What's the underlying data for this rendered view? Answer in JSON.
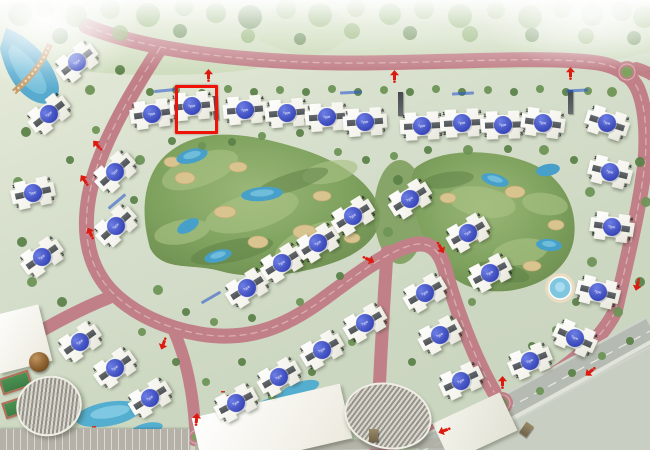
{
  "map": {
    "unit_type_label": "Type",
    "corner_unit_numbers": [
      "1",
      "4",
      "2",
      "3"
    ],
    "selected_building": {
      "index": 7,
      "x": 175,
      "y": 85,
      "w": 37,
      "h": 43
    },
    "buildings_xyr": [
      [
        77,
        62,
        -38
      ],
      [
        49,
        114,
        -38
      ],
      [
        33,
        193,
        -12
      ],
      [
        42,
        257,
        -35
      ],
      [
        115,
        172,
        -42
      ],
      [
        116,
        226,
        -42
      ],
      [
        152,
        114,
        -8
      ],
      [
        192,
        106,
        -5
      ],
      [
        245,
        110,
        -5
      ],
      [
        287,
        113,
        -5
      ],
      [
        327,
        117,
        -4
      ],
      [
        365,
        122,
        -4
      ],
      [
        422,
        126,
        -3
      ],
      [
        462,
        123,
        -3
      ],
      [
        503,
        125,
        -2
      ],
      [
        543,
        123,
        8
      ],
      [
        607,
        123,
        18
      ],
      [
        610,
        172,
        14
      ],
      [
        612,
        227,
        8
      ],
      [
        598,
        292,
        14
      ],
      [
        575,
        338,
        24
      ],
      [
        247,
        288,
        -32
      ],
      [
        282,
        263,
        -32
      ],
      [
        318,
        243,
        -32
      ],
      [
        353,
        216,
        -32
      ],
      [
        410,
        199,
        -32
      ],
      [
        468,
        233,
        -30
      ],
      [
        490,
        273,
        -28
      ],
      [
        425,
        293,
        -30
      ],
      [
        80,
        342,
        -35
      ],
      [
        115,
        368,
        -35
      ],
      [
        150,
        398,
        -32
      ],
      [
        365,
        323,
        -30
      ],
      [
        322,
        350,
        -30
      ],
      [
        279,
        377,
        -30
      ],
      [
        236,
        403,
        -28
      ],
      [
        440,
        335,
        -28
      ],
      [
        461,
        381,
        -25
      ],
      [
        530,
        361,
        -22
      ]
    ],
    "direction_arrows": [
      [
        208,
        75,
        0
      ],
      [
        394,
        76,
        0
      ],
      [
        570,
        73,
        0
      ],
      [
        97,
        145,
        -42
      ],
      [
        84,
        180,
        -35
      ],
      [
        90,
        233,
        -25
      ],
      [
        368,
        259,
        115
      ],
      [
        440,
        247,
        150
      ],
      [
        637,
        284,
        195
      ],
      [
        590,
        371,
        230
      ],
      [
        196,
        419,
        5
      ],
      [
        502,
        382,
        0
      ],
      [
        444,
        430,
        250
      ],
      [
        163,
        343,
        200
      ]
    ],
    "colors": {
      "road_pink": "#c18088",
      "road_outer_gray": "#b5bbb2",
      "golf_green": "#7fa25f",
      "water_blue": "#47a0c9",
      "building_roof_gray": "#565b5f",
      "unit_circle_blue": "#3f52c6",
      "selection_red": "#ee1209",
      "arrow_red": "#dd1a10",
      "bunker_sand": "#d9c48f"
    },
    "amenities": [
      "golf-course",
      "lakes",
      "swimming-pool",
      "lazy-river",
      "clubhouse",
      "amphitheater",
      "dome-pavilion",
      "sports-courts",
      "parking",
      "entrance-roundabouts"
    ]
  }
}
